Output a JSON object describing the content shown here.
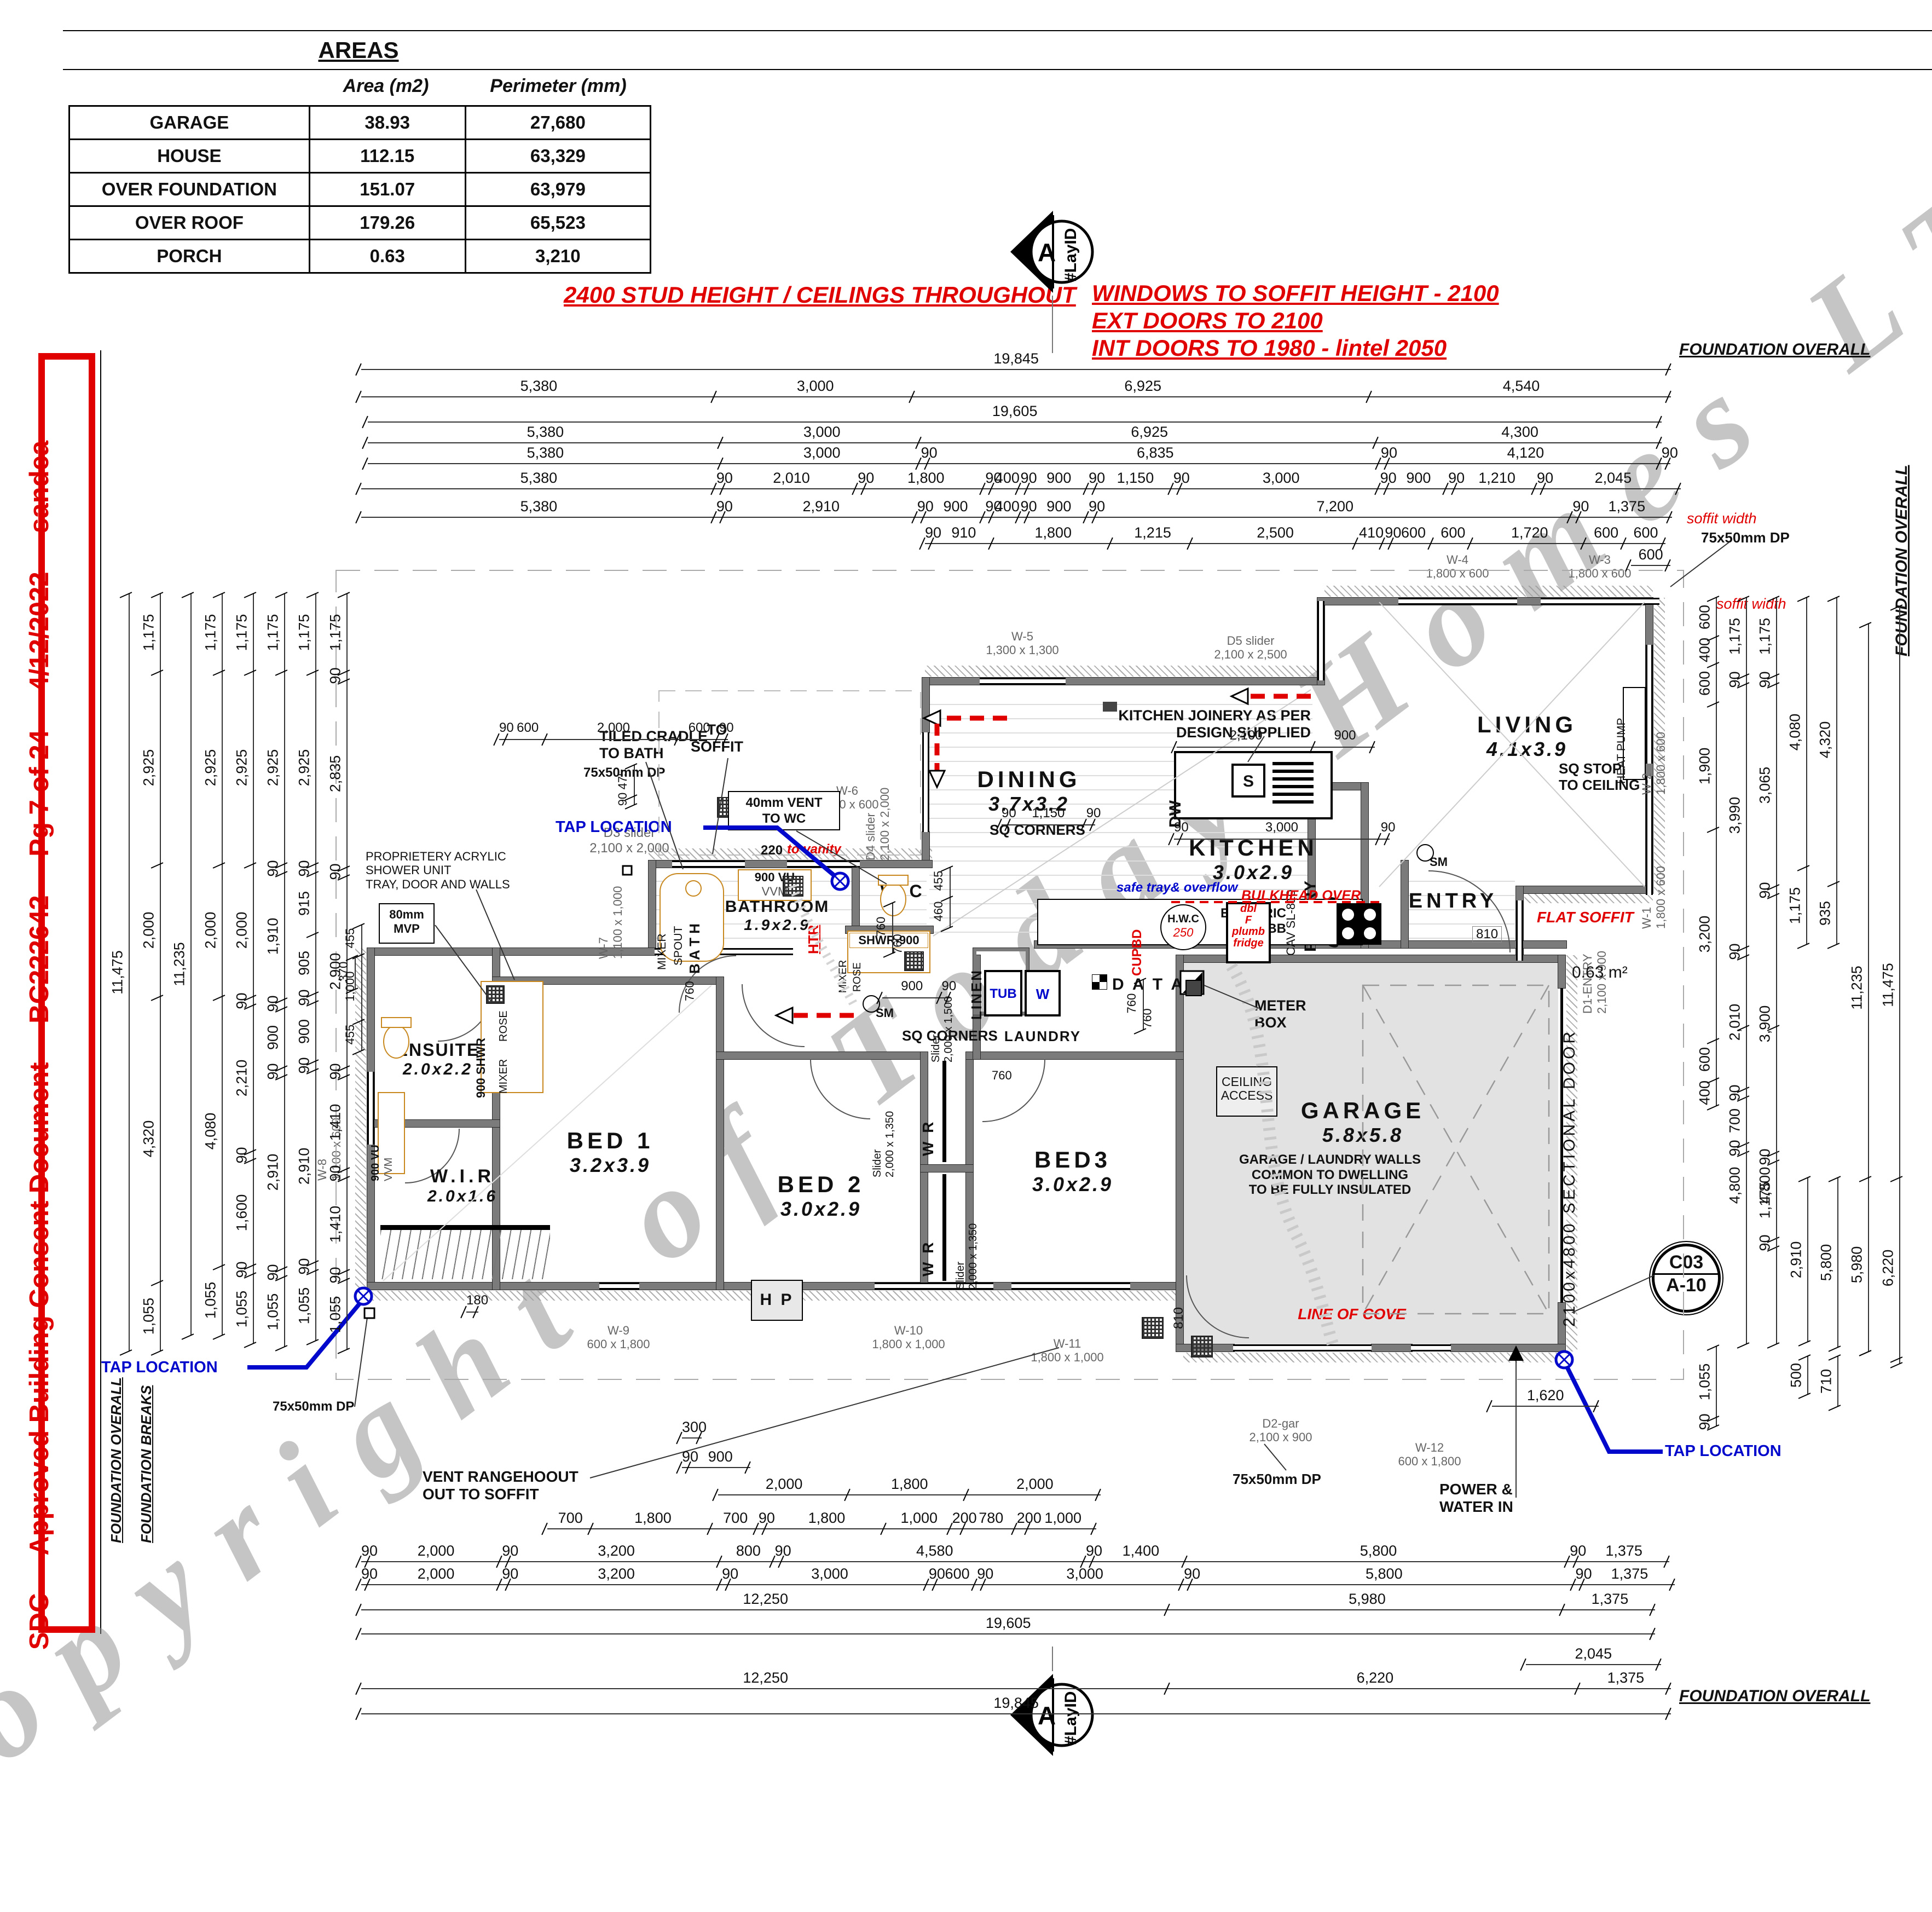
{
  "areas_table": {
    "title": "AREAS",
    "headers": [
      "Area (m2)",
      "Perimeter (mm)"
    ],
    "rows": [
      [
        "GARAGE",
        "38.93",
        "27,680"
      ],
      [
        "HOUSE",
        "112.15",
        "63,329"
      ],
      [
        "OVER FOUNDATION",
        "151.07",
        "63,979"
      ],
      [
        "OVER ROOF",
        "179.26",
        "65,523"
      ],
      [
        "PORCH",
        "0.63",
        "3,210"
      ]
    ]
  },
  "notes": {
    "ceiling": "2400 STUD HEIGHT / CEILINGS THROUGHOUT",
    "windows": "WINDOWS TO SOFFIT HEIGHT - 2100",
    "ext_doors": "EXT DOORS TO 2100",
    "int_doors": "INT DOORS TO 1980 - lintel 2050"
  },
  "consent_strip": "SDC  -  Approved Building Consent Document  -  BC222642  -  Pg 7 of 24  -  4/12/2022  -  sandea",
  "watermark": "Copyright of Today Homes LTD",
  "markers": {
    "section_letter": "A",
    "section_tag": "#LayID",
    "detail_code": "C03",
    "detail_sheet": "A-10"
  },
  "rooms": {
    "living": {
      "name": "LIVING",
      "size": "4.1x3.9"
    },
    "dining": {
      "name": "DINING",
      "size": "3.7x3.2"
    },
    "kitchen": {
      "name": "KITCHEN",
      "size": "3.0x2.9"
    },
    "pantry": {
      "name": "PANTRY",
      "size": "0.9x2.0"
    },
    "entry": {
      "name": "ENTRY"
    },
    "bathroom": {
      "name": "BATHROOM",
      "size": "1.9x2.9"
    },
    "wc": {
      "name": "W C"
    },
    "linen": {
      "name": "LINEN"
    },
    "laundry": {
      "name": "LAUNDRY"
    },
    "bed1": {
      "name": "BED 1",
      "size": "3.2x3.9"
    },
    "bed2": {
      "name": "BED 2",
      "size": "3.0x2.9"
    },
    "bed3": {
      "name": "BED3",
      "size": "3.0x2.9"
    },
    "ensuite": {
      "name": "ENSUITE",
      "size": "2.0x2.2"
    },
    "wir": {
      "name": "W.I.R",
      "size": "2.0x1.6"
    },
    "garage": {
      "name": "GARAGE",
      "size": "5.8x5.8"
    }
  },
  "fixtures": {
    "dw": "DW",
    "sink": "S",
    "tub": "TUB",
    "washer": "W",
    "hp": "H P",
    "heat_pump": "HEAT PUMP",
    "hwc": "H.W.C",
    "hwc_capacity": "250",
    "data": "D A T A",
    "electric_hob": "ELECTRIC\nHOBB",
    "fridge": "dbl\nF\nplumb\nfridge",
    "cupbd": "CUPBD",
    "bath": "B A T H",
    "spout": "SPOUT",
    "mixer": "MIXER",
    "rose": "ROSE",
    "shwr_900": "SHWR-900",
    "shwr_900v": "900 SHWR",
    "vanity_900": "900 VU",
    "vanity_vvm": "VVM",
    "wr": "W R",
    "htr": "HTR",
    "sm": "SM"
  },
  "openings": {
    "w1": "W-1\n1,800 x 600",
    "w2": "W-2\n1,800 x 600",
    "w3": "W-3\n1,800 x 600",
    "w4": "W-4\n1,800 x 600",
    "w5": "W-5\n1,300 x 1,300",
    "w6": "W-6\n1,100 x 600",
    "w7": "W-7\n1,100 x 1,000",
    "w8": "W-8\n1,100 x 600",
    "w9": "W-9\n600 x 1,800",
    "w10": "W-10\n1,800 x 1,000",
    "w11": "W-11\n1,800 x 1,000",
    "w12": "W-12\n600 x 1,800",
    "d1": "D1-ENTRY\n2,100 x 900",
    "d2": "D2-gar\n2,100 x 900",
    "d3": "D3 slider\n2,100 x 2,000",
    "d4": "D4 slider\n2,100 x 2,000",
    "d5": "D5 slider\n2,100 x 2,500",
    "cav": "CAV SL-810",
    "sectional": "2100x4800 SECTIONAL DOOR",
    "slider_1350": "Slider\n2,000 x 1,350",
    "slider_1500": "Slider\n2,000 x 1,500",
    "door_810": "810"
  },
  "annotations": {
    "foundation_overall": "FOUNDATION OVERALL",
    "foundation_breaks": "FOUNDATION BREAKS",
    "soffit_width": "soffit width",
    "dp": "75x50mm DP",
    "tap_location": "TAP LOCATION",
    "power_water": "POWER &\nWATER IN",
    "vent_range": "VENT RANGEHOOUT\nOUT TO SOFFIT",
    "line_of_cove": "LINE OF COVE",
    "garage_walls": "GARAGE / LAUNDRY WALLS\nCOMMON TO DWELLING\nTO BE FULLY INSULATED",
    "ceiling_access": "CEILING\nACCESS",
    "meter_box": "METER\nBOX",
    "kitchen_joinery": "KITCHEN JOINERY AS PER\nDESIGN SUPPLIED",
    "sq_stop": "SQ STOP\nTO CEILING",
    "sq_corners": "SQ CORNERS",
    "flat_soffit": "FLAT SOFFIT",
    "bulkhead": "BULKHEAD OVER",
    "safe_tray": "safe tray& overflow",
    "to_vanity_dim": "220",
    "to_vanity": "to vanity",
    "vent_wc": "40mm VENT\nTO WC",
    "to_soffit": "TO\nSOFFIT",
    "tiled_cradle": "TILED CRADLE\nTO BATH",
    "shower_unit": "PROPRIETERY ACRYLIC\nSHOWER UNIT\nTRAY, DOOR AND WALLS",
    "mvp": "80mm\nMVP",
    "porch_area": "0.63 m²"
  },
  "dims": {
    "top_rows": [
      [
        "19,845"
      ],
      [
        "5,380",
        "3,000",
        "6,925",
        "4,540"
      ],
      [
        "19,605"
      ],
      [
        "5,380",
        "3,000",
        "6,925",
        "4,300"
      ],
      [
        "5,380",
        "3,000",
        "90",
        "6,835",
        "90",
        "4,120",
        "90"
      ],
      [
        "5,380",
        "90",
        "2,010",
        "90",
        "1,800",
        "90",
        "400",
        "90",
        "900",
        "90",
        "1,150",
        "90",
        "3,000",
        "90",
        "900",
        "90",
        "1,210",
        "90",
        "2,045"
      ],
      [
        "5,380",
        "90",
        "2,910",
        "90",
        "900",
        "90",
        "400",
        "90",
        "900",
        "90",
        "7,200",
        "90",
        "1,375"
      ],
      [
        "90",
        "910",
        "1,800",
        "1,215",
        "2,500",
        "410",
        "90",
        "600",
        "600",
        "1,720",
        "600",
        "600"
      ],
      [
        "600"
      ]
    ],
    "bottom_rows": [
      [
        "1,620"
      ],
      [
        "300"
      ],
      [
        "90",
        "900"
      ],
      [
        "2,000",
        "1,800",
        "2,000"
      ],
      [
        "700",
        "1,800",
        "700",
        "90",
        "1,800",
        "1,000",
        "200",
        "780",
        "200",
        "1,000"
      ],
      [
        "90",
        "2,000",
        "90",
        "3,200",
        "800",
        "90",
        "4,580",
        "90",
        "1,400",
        "5,800",
        "90",
        "1,375"
      ],
      [
        "90",
        "2,000",
        "90",
        "3,200",
        "90",
        "3,000",
        "90",
        "600",
        "90",
        "3,000",
        "90",
        "5,800",
        "90",
        "1,375"
      ],
      [
        "12,250",
        "5,980",
        "1,375"
      ],
      [
        "19,605"
      ],
      [
        "2,045"
      ],
      [
        "12,250",
        "6,220",
        "1,375"
      ],
      [
        "19,845"
      ]
    ],
    "left_cols": [
      [
        "11,475"
      ],
      [
        "1,175",
        "2,925",
        "2,000",
        "4,320",
        "1,055"
      ],
      [
        "11,235"
      ],
      [
        "1,175",
        "2,925",
        "2,000",
        "4,080",
        "1,055"
      ],
      [
        "1,175",
        "2,925",
        "2,000",
        "90",
        "2,210",
        "90",
        "1,600",
        "90",
        "1,055"
      ],
      [
        "1,175",
        "2,925",
        "90",
        "1,910",
        "90",
        "900",
        "90",
        "2,910",
        "90",
        "1,055"
      ],
      [
        "1,175",
        "2,925",
        "90",
        "915",
        "905",
        "90",
        "900",
        "90",
        "2,910",
        "90",
        "1,055"
      ],
      [
        "1,175",
        "90",
        "2,835",
        "90",
        "2,900",
        "90",
        "1,410",
        "90",
        "1,410",
        "90",
        "1,055"
      ]
    ],
    "right_cols": [
      [
        "600",
        "400",
        "600",
        "1,900",
        "3,200",
        "600",
        "400"
      ],
      [
        "1,175",
        "90",
        "3,990",
        "90",
        "2,010",
        "90",
        "700",
        "90"
      ],
      [
        "1,175",
        "90",
        "3,065",
        "90",
        "3,900",
        "90",
        "1,175",
        "90"
      ],
      [
        "4,080",
        "1,175"
      ],
      [
        "4,320",
        "935"
      ],
      [
        "11,235"
      ],
      [
        "11,475"
      ],
      [
        "4,800"
      ],
      [
        "4,800"
      ],
      [
        "2,910"
      ],
      [
        "5,800"
      ],
      [
        "5,980"
      ],
      [
        "6,220"
      ],
      [
        "500"
      ],
      [
        "710"
      ],
      [
        "1,055",
        "90"
      ]
    ],
    "misc_rows": [
      [
        "2,100",
        "900"
      ],
      [
        "90",
        "3,000",
        "90"
      ],
      [
        "90",
        "1,150",
        "90"
      ],
      [
        "900",
        "90"
      ],
      [
        "180"
      ],
      [
        "90",
        "600",
        "2,000",
        "600",
        "90"
      ]
    ],
    "misc_cols": [
      [
        "475",
        "90"
      ],
      [
        "455",
        "460"
      ],
      [
        "455",
        "1,000",
        "455"
      ],
      [
        "760"
      ],
      [
        "760"
      ],
      [
        "370"
      ]
    ]
  }
}
